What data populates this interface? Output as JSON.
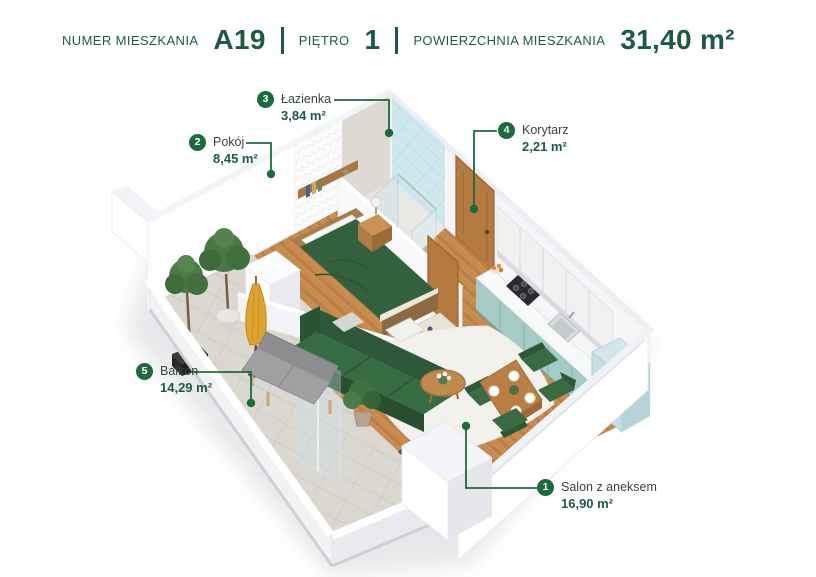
{
  "header": {
    "fields": [
      {
        "label": "NUMER MIESZKANIA",
        "value": "A19"
      },
      {
        "label": "PIĘTRO",
        "value": "1"
      },
      {
        "label": "POWIERZCHNIA MIESZKANIA",
        "value": "31,40 m²"
      }
    ]
  },
  "rooms": [
    {
      "number": "1",
      "name": "Salon z aneksem",
      "area": "16,90 m²"
    },
    {
      "number": "2",
      "name": "Pokój",
      "area": "8,45 m²"
    },
    {
      "number": "3",
      "name": "Łazienka",
      "area": "3,84 m²"
    },
    {
      "number": "4",
      "name": "Korytarz",
      "area": "2,21 m²"
    },
    {
      "number": "5",
      "name": "Balkon",
      "area": "14,29 m²"
    }
  ],
  "colors": {
    "brand_green": "#1c6b3c",
    "text_green": "#1d5b40",
    "bathroom_tile_blue": "#cfe8ee",
    "kitchen_teal": "#a5cbc6",
    "sofa_green": "#33613e",
    "wood_floor": "#c68b4f"
  }
}
